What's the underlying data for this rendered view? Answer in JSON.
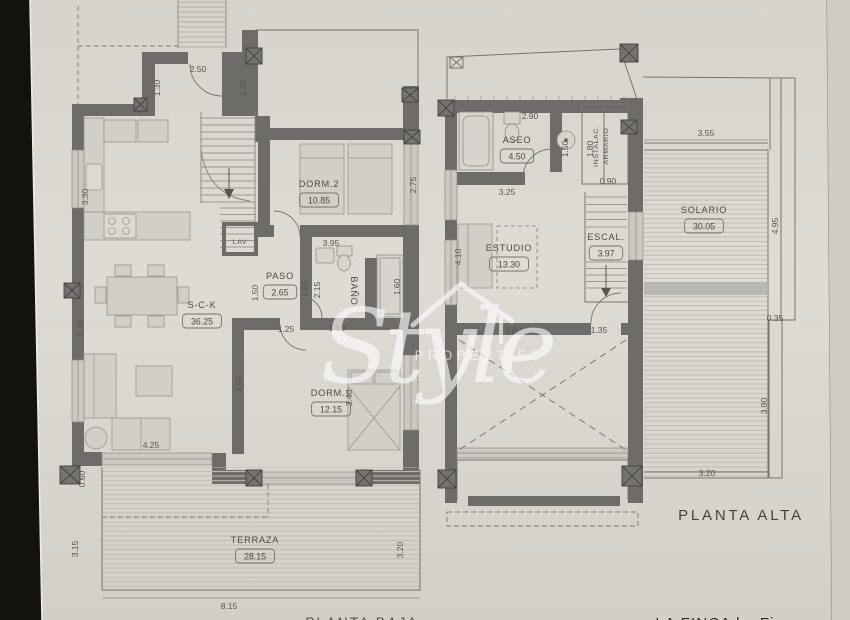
{
  "meta": {
    "caption_planta_alta": "PLANTA ALTA",
    "caption_planta_baja": "PLANTA BAJA",
    "caption_bottom_right": "LA FINCA by Fi"
  },
  "watermark": {
    "script": "Style",
    "caps": "PROPERTIES",
    "color": "#ffffff"
  },
  "colors": {
    "photo_background": "#14120f",
    "paper": "#dad7d1",
    "wall": "#6e6c68",
    "line": "#56544f",
    "hatch": "#bfbcb6"
  },
  "plans": {
    "baja": {
      "title": "PLANTA BAJA",
      "rooms": [
        {
          "label": "DORM.2",
          "area": "10.85",
          "x": 319,
          "y": 187
        },
        {
          "label": "PASO",
          "area": "2.65",
          "x": 280,
          "y": 279
        },
        {
          "label": "S-C-K",
          "area": "36.25",
          "x": 202,
          "y": 308
        },
        {
          "label": "BAÑO",
          "x": 351,
          "y": 291,
          "r": 90
        },
        {
          "label": "DORM.1",
          "area": "12.15",
          "x": 331,
          "y": 396
        },
        {
          "label": "TERRAZA",
          "area": "28.15",
          "x": 255,
          "y": 543
        },
        {
          "label": "LAV",
          "x": 240,
          "y": 244,
          "small": true
        }
      ],
      "dims": [
        {
          "t": "2.50",
          "x": 198,
          "y": 72
        },
        {
          "t": "1.30",
          "x": 160,
          "y": 88,
          "r": -90
        },
        {
          "t": "1.30",
          "x": 246,
          "y": 88,
          "r": -90
        },
        {
          "t": "3.30",
          "x": 88,
          "y": 197,
          "r": -90
        },
        {
          "t": "2.75",
          "x": 416,
          "y": 185,
          "r": -90
        },
        {
          "t": "3.95",
          "x": 331,
          "y": 246
        },
        {
          "t": "1.50",
          "x": 258,
          "y": 293,
          "r": -90
        },
        {
          "t": "1.65",
          "x": 308,
          "y": 289,
          "r": -90
        },
        {
          "t": "2.15",
          "x": 320,
          "y": 290,
          "r": -90
        },
        {
          "t": "1.60",
          "x": 400,
          "y": 287,
          "r": -90
        },
        {
          "t": "1.25",
          "x": 286,
          "y": 332
        },
        {
          "t": "1.50",
          "x": 337,
          "y": 331
        },
        {
          "t": "5.30",
          "x": 83,
          "y": 328,
          "r": -90
        },
        {
          "t": "3.50",
          "x": 242,
          "y": 384,
          "r": -90
        },
        {
          "t": "3.40",
          "x": 352,
          "y": 398,
          "r": -90
        },
        {
          "t": "4.25",
          "x": 151,
          "y": 448
        },
        {
          "t": "0.60",
          "x": 85,
          "y": 479,
          "r": -90
        },
        {
          "t": "3.15",
          "x": 78,
          "y": 549,
          "r": -90
        },
        {
          "t": "3.20",
          "x": 403,
          "y": 550,
          "r": -90
        },
        {
          "t": "8.15",
          "x": 229,
          "y": 609
        }
      ]
    },
    "alta": {
      "title": "PLANTA ALTA",
      "rooms": [
        {
          "label": "ASEO",
          "area": "4.50",
          "x": 517,
          "y": 143
        },
        {
          "label": "INSTALAC.",
          "x": 598,
          "y": 146,
          "r": -90,
          "small": true
        },
        {
          "label": "ARMARIO",
          "x": 608,
          "y": 146,
          "r": -90,
          "small": true
        },
        {
          "label": "ESTUDIO",
          "area": "13.30",
          "x": 509,
          "y": 251
        },
        {
          "label": "ESCAL.",
          "area": "3.97",
          "x": 606,
          "y": 240
        },
        {
          "label": "SOLARIO",
          "area": "30.05",
          "x": 704,
          "y": 213
        }
      ],
      "dims": [
        {
          "t": "2.90",
          "x": 530,
          "y": 119
        },
        {
          "t": "1.50",
          "x": 568,
          "y": 149,
          "r": -90
        },
        {
          "t": "1.80",
          "x": 593,
          "y": 149,
          "r": -90
        },
        {
          "t": "0.90",
          "x": 608,
          "y": 184
        },
        {
          "t": "3.25",
          "x": 507,
          "y": 195
        },
        {
          "t": "4.10",
          "x": 461,
          "y": 257,
          "r": -90
        },
        {
          "t": "3.55",
          "x": 706,
          "y": 136
        },
        {
          "t": "4.95",
          "x": 778,
          "y": 226,
          "r": -90
        },
        {
          "t": "3.00",
          "x": 513,
          "y": 333
        },
        {
          "t": "1.35",
          "x": 599,
          "y": 333
        },
        {
          "t": "0.35",
          "x": 775,
          "y": 321
        },
        {
          "t": "3.90",
          "x": 767,
          "y": 406,
          "r": -90
        },
        {
          "t": "3.20",
          "x": 707,
          "y": 476
        }
      ]
    }
  }
}
